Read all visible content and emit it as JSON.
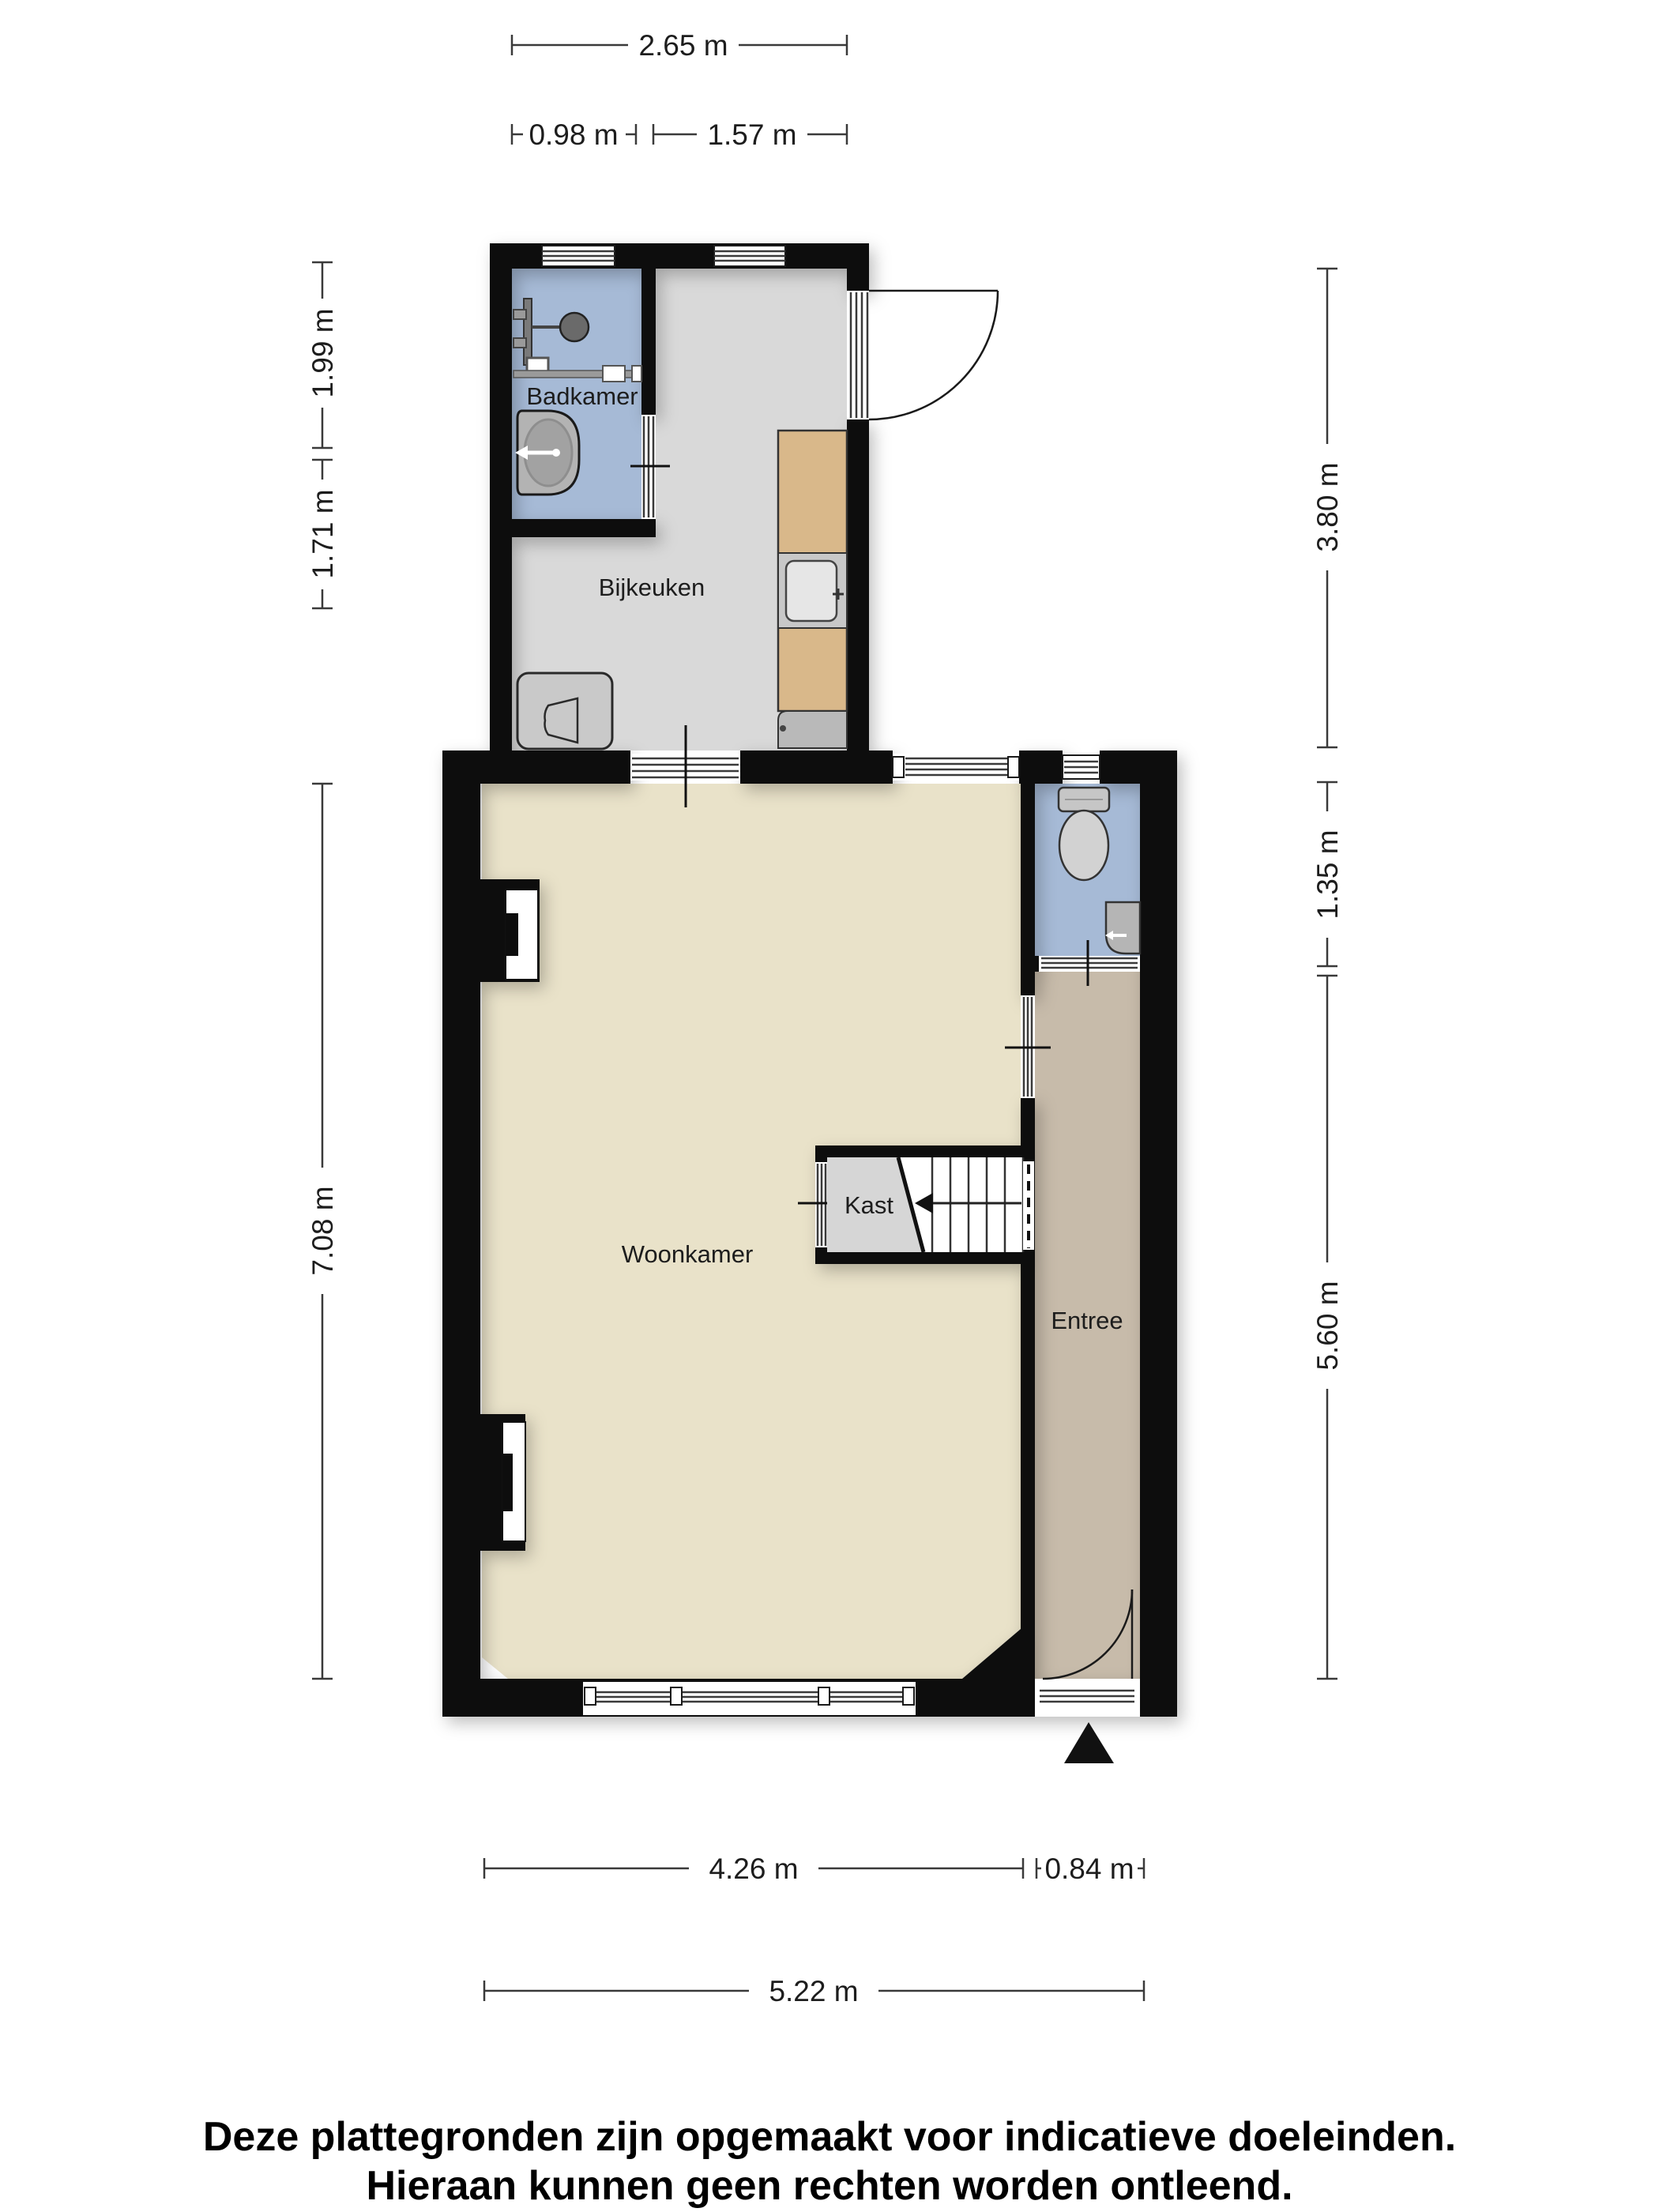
{
  "floorplan": {
    "rooms": [
      {
        "label": "Badkamer"
      },
      {
        "label": "Bijkeuken"
      },
      {
        "label": "Woonkamer"
      },
      {
        "label": "Kast"
      },
      {
        "label": "Entree"
      }
    ],
    "dimensions": {
      "top_total": "2.65 m",
      "top_left": "0.98 m",
      "top_right": "1.57 m",
      "left_upper": "1.99 m",
      "left_mid": "1.71 m",
      "left_lower": "7.08 m",
      "right_upper": "3.80 m",
      "right_mid": "1.35 m",
      "right_lower": "5.60 m",
      "bottom_left": "4.26 m",
      "bottom_right": "0.84 m",
      "bottom_total": "5.22 m"
    },
    "disclaimer": {
      "line1": "Deze plattegronden zijn opgemaakt voor indicatieve doeleinden.",
      "line2": "Hieraan kunnen geen rechten worden ontleend."
    },
    "colors": {
      "wall": "#0d0d0d",
      "bathroom_floor": "#a6bad6",
      "utility_floor": "#d9d9d9",
      "living_floor": "#e9e2c9",
      "hall_floor": "#c7bbaa",
      "closet_floor": "#d6d6d6",
      "counter_wood": "#d9b88a",
      "fixture_gray": "#c6c6c6"
    }
  }
}
